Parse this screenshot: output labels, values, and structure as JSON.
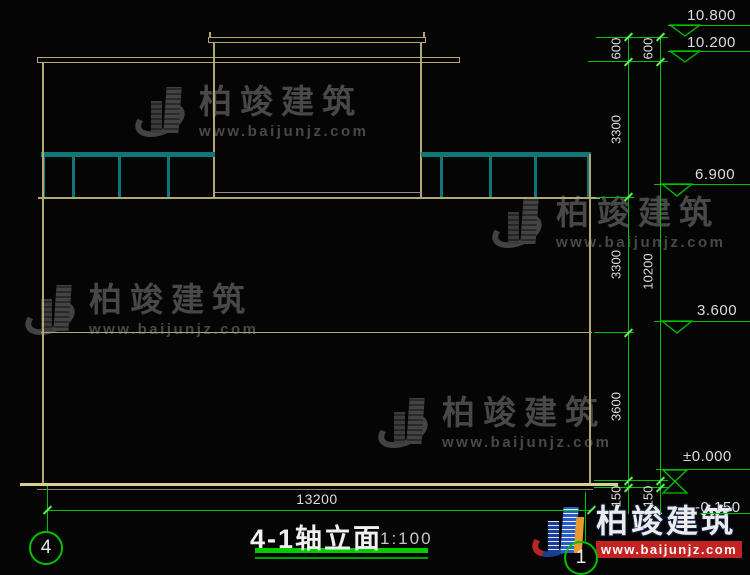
{
  "title": {
    "text": "4-1轴立面",
    "scale": "1:100"
  },
  "axis_bubbles": {
    "left": "4",
    "right": "1"
  },
  "elevation_labels": {
    "parapet_top": "10.800",
    "roof": "10.200",
    "third_floor": "6.900",
    "second_floor": "3.600",
    "ground": "±0.000",
    "base": "-0.150"
  },
  "dims": {
    "d600_a": "600",
    "d600_b": "600",
    "d3300_a": "3300",
    "d3300_b": "3300",
    "d10200": "10200",
    "d3600": "3600",
    "d150_a": "150",
    "d150_b": "150",
    "d13200": "13200"
  },
  "watermark": {
    "brand": "柏竣建筑",
    "url": "www.baijunjz.com"
  },
  "colors": {
    "background": "#050505",
    "building_line": "#b3a772",
    "ground_line": "#dbce90",
    "railing": "#0f7777",
    "dimension_green": "#00c300",
    "tick_green": "#5aef5a",
    "text": "#dcdcdc",
    "watermark_gray": "#484848",
    "brand_red": "#c52222",
    "logo_blue": "#2a5ccc",
    "title_underline": "#00cc00"
  }
}
